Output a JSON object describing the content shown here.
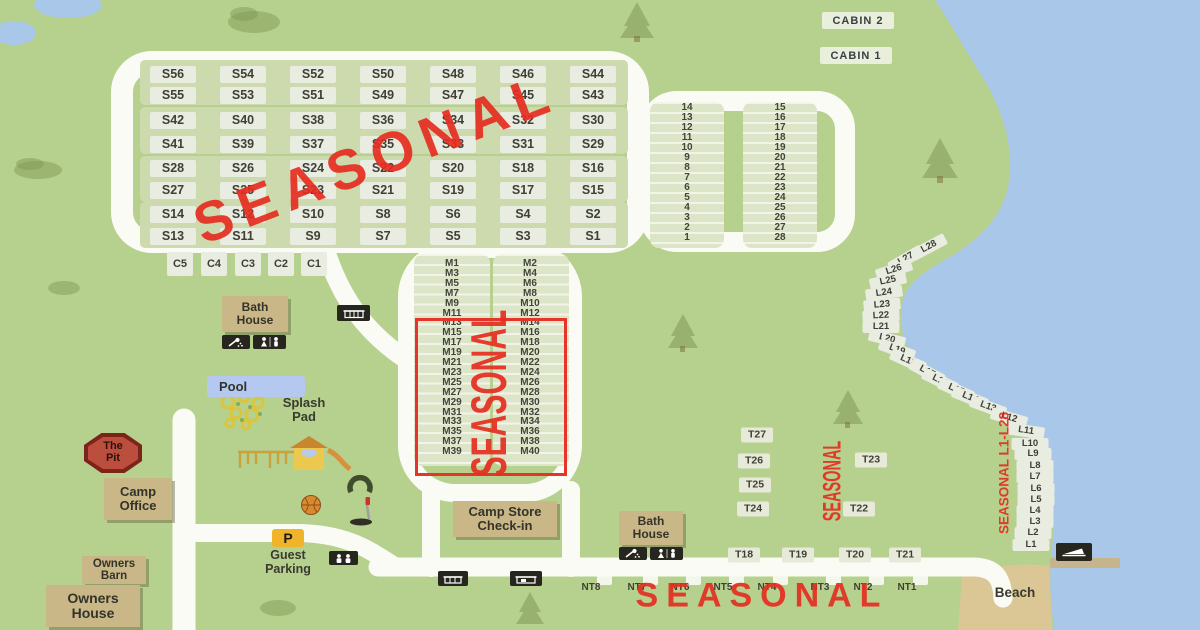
{
  "overlays": {
    "seasonal": "SEASONAL",
    "seasonal_range": "SEASONAL L1-L28"
  },
  "areas": {
    "s_rows": [
      [
        "S56",
        "S54",
        "S52",
        "S50",
        "S48",
        "S46",
        "S44"
      ],
      [
        "S55",
        "S53",
        "S51",
        "S49",
        "S47",
        "S45",
        "S43"
      ],
      [
        "S42",
        "S40",
        "S38",
        "S36",
        "S34",
        "S32",
        "S30"
      ],
      [
        "S41",
        "S39",
        "S37",
        "S35",
        "S33",
        "S31",
        "S29"
      ],
      [
        "S28",
        "S26",
        "S24",
        "S22",
        "S20",
        "S18",
        "S16"
      ],
      [
        "S27",
        "S25",
        "S23",
        "S21",
        "S19",
        "S17",
        "S15"
      ],
      [
        "S14",
        "S12",
        "S10",
        "S8",
        "S6",
        "S4",
        "S2"
      ],
      [
        "S13",
        "S11",
        "S9",
        "S7",
        "S5",
        "S3",
        "S1"
      ]
    ],
    "c_sites": [
      "C5",
      "C4",
      "C3",
      "C2",
      "C1"
    ],
    "num_left": [
      "14",
      "13",
      "12",
      "11",
      "10",
      "9",
      "8",
      "7",
      "6",
      "5",
      "4",
      "3",
      "2",
      "1"
    ],
    "num_right": [
      "15",
      "16",
      "17",
      "18",
      "19",
      "20",
      "21",
      "22",
      "23",
      "24",
      "25",
      "26",
      "27",
      "28"
    ],
    "m_left": [
      "M1",
      "M3",
      "M5",
      "M7",
      "M9",
      "M11",
      "M13",
      "M15",
      "M17",
      "M19",
      "M21",
      "M23",
      "M25",
      "M27",
      "M29",
      "M31",
      "M33",
      "M35",
      "M37",
      "M39"
    ],
    "m_right": [
      "M2",
      "M4",
      "M6",
      "M8",
      "M10",
      "M12",
      "M14",
      "M16",
      "M18",
      "M20",
      "M22",
      "M24",
      "M26",
      "M28",
      "M30",
      "M32",
      "M34",
      "M36",
      "M38",
      "M40"
    ],
    "l_sites": [
      "L28",
      "L27",
      "L26",
      "L25",
      "L24",
      "L23",
      "L22",
      "L21",
      "L20",
      "L19",
      "L18",
      "L17",
      "L16",
      "L15",
      "L14",
      "L13",
      "L12",
      "L11",
      "L10",
      "L9",
      "L8",
      "L7",
      "L6",
      "L5",
      "L4",
      "L3",
      "L2",
      "L1"
    ],
    "t_upper": [
      "T27",
      "T26",
      "T25",
      "T24"
    ],
    "t_right": [
      "T23",
      "T22"
    ],
    "t_lower": [
      "T18",
      "T19",
      "T20",
      "T21"
    ],
    "nt_sites": [
      "NT8",
      "NT7",
      "NT6",
      "NT5",
      "NT4",
      "NT3",
      "NT2",
      "NT1"
    ],
    "cabins": [
      "CABIN 2",
      "CABIN 1"
    ]
  },
  "landmarks": {
    "bath_house": "Bath House",
    "bath_house_2": "Bath House",
    "pool": "Pool",
    "splash_pad": "Splash Pad",
    "the_pit": "The Pit",
    "camp_office": "Camp Office",
    "owners_barn": "Owners Barn",
    "owners_house": "Owners House",
    "guest_parking": "Guest Parking",
    "parking_p": "P",
    "camp_store": "Camp Store Check-in",
    "beach": "Beach"
  },
  "colors": {
    "grass": "#b6d08e",
    "water": "#a9c7e8",
    "road": "#fafbf4",
    "site_pad": "#e9ece0",
    "band": "#ccdaae",
    "building": "#c9b787",
    "accent_red": "#e5352a",
    "sand": "#dbc795",
    "pool_blue": "#b5c8f0",
    "sign_yellow": "#f0b42a"
  }
}
